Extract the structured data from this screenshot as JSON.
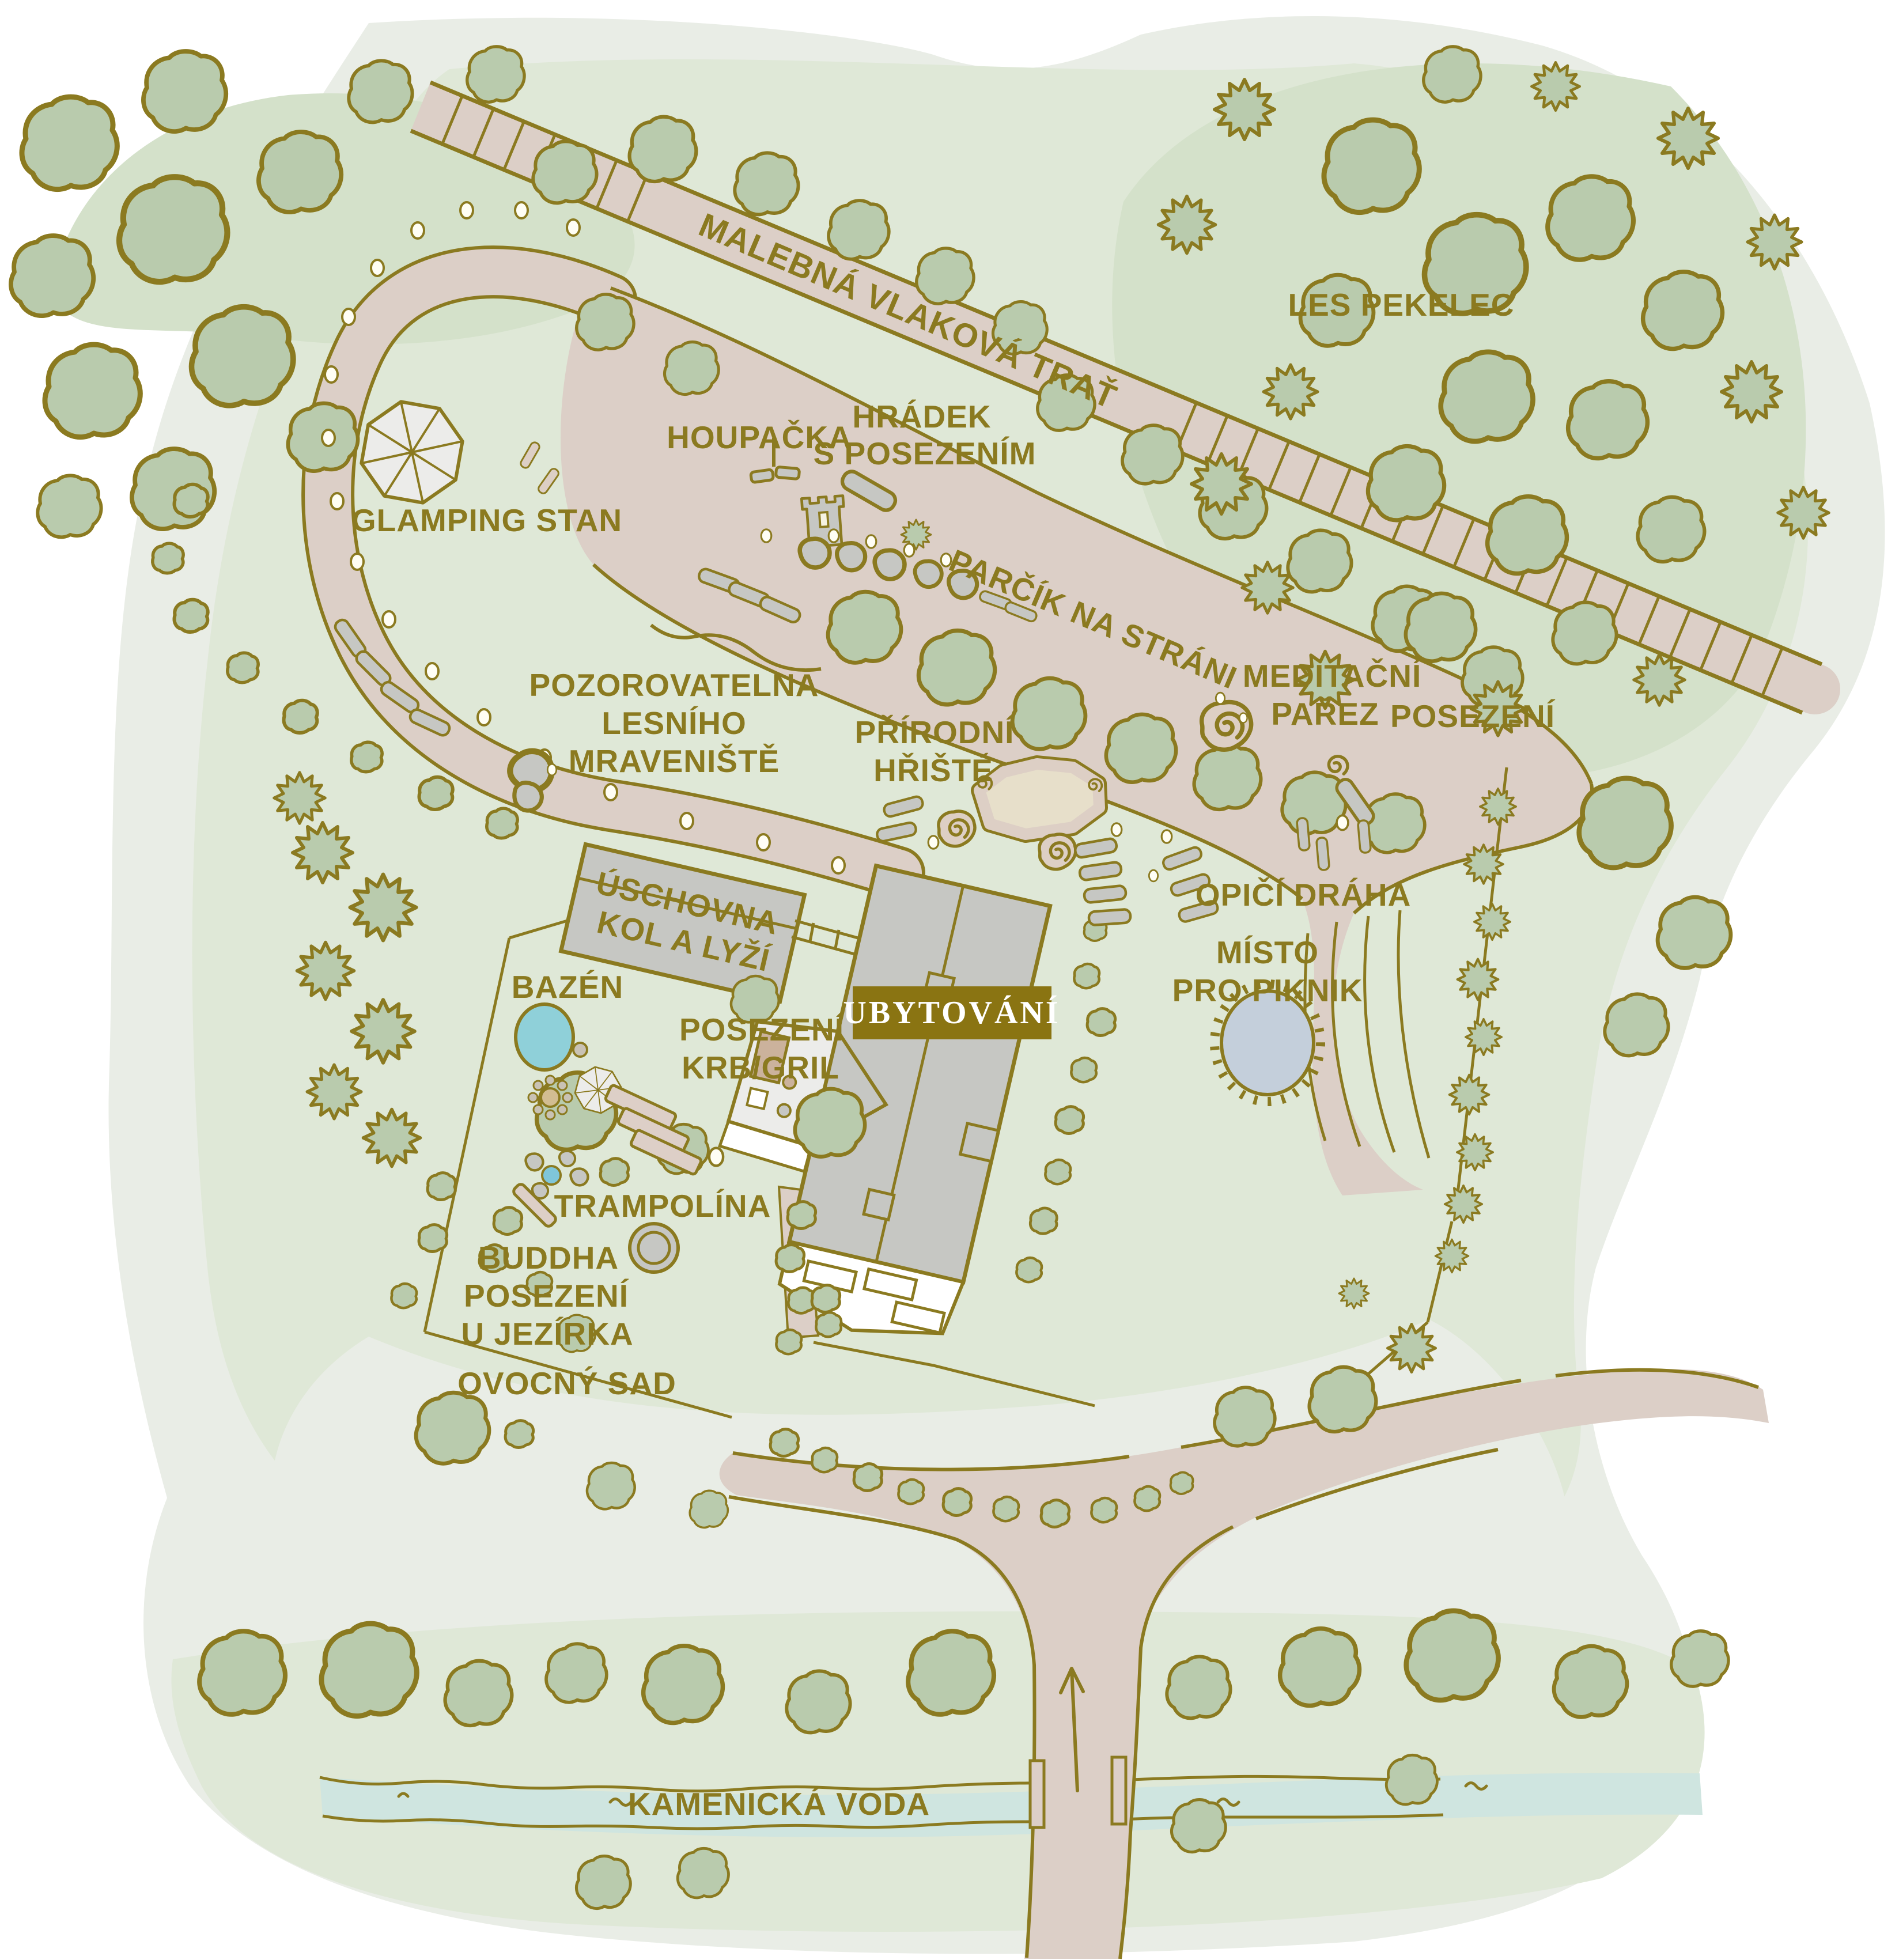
{
  "map": {
    "type": "illustrated-resort-site-plan",
    "labels": {
      "railway": "MALEBNÁ VLAKOVÁ TRAŤ",
      "forest": "LES PEKELEC",
      "swing": "HOUPAČKA",
      "castle": [
        "HRÁDEK",
        "S POSEZENÍM"
      ],
      "glamping": "GLAMPING STAN",
      "park": "PARČÍK NA STRÁNI",
      "meditation": [
        "MEDITAČNÍ",
        "PAŘEZ"
      ],
      "seating_hillside": "POSEZENÍ",
      "observatory": [
        "POZOROVATELNA",
        "LESNÍHO",
        "MRAVENIŠTĚ"
      ],
      "playground": [
        "PŘÍRODNÍ",
        "HŘIŠTĚ"
      ],
      "storage": [
        "ÚSCHOVNA",
        "KOL A LYŽÍ"
      ],
      "monkey_bars": "OPIČÍ DRÁHA",
      "picnic": [
        "MÍSTO",
        "PRO PIKNIK"
      ],
      "pool": "BAZÉN",
      "seating_grill": [
        "POSEZENÍ",
        "KRB/GRIL"
      ],
      "accommodation": "UBYTOVÁNÍ",
      "trampoline": "TRAMPOLÍNA",
      "buddha": [
        "BUDDHA",
        "POSEZENÍ",
        "U JEZÍRKA"
      ],
      "orchard": "OVOCNÝ SAD",
      "river": "KAMENICKÁ VODA"
    },
    "colors": {
      "outline_olive": "#8b7a20",
      "label_text": "#8b7a20",
      "terrain_outer": "#e9ede6",
      "terrain_green": "#dfe8d7",
      "terrain_dark_green": "#d4e1ca",
      "tree_fill": "#b9cbad",
      "path_pink": "#dccfc7",
      "building_gray": "#c6c7c3",
      "pool_blue": "#8fd0d9",
      "pond_blue": "#7fc6da",
      "picnic_blue_gray": "#c4cfdb",
      "river_blue": "#cfe5e0",
      "badge_bg": "#8a7412",
      "badge_text": "#ffffff",
      "sand_tan": "#e7dfca"
    }
  }
}
